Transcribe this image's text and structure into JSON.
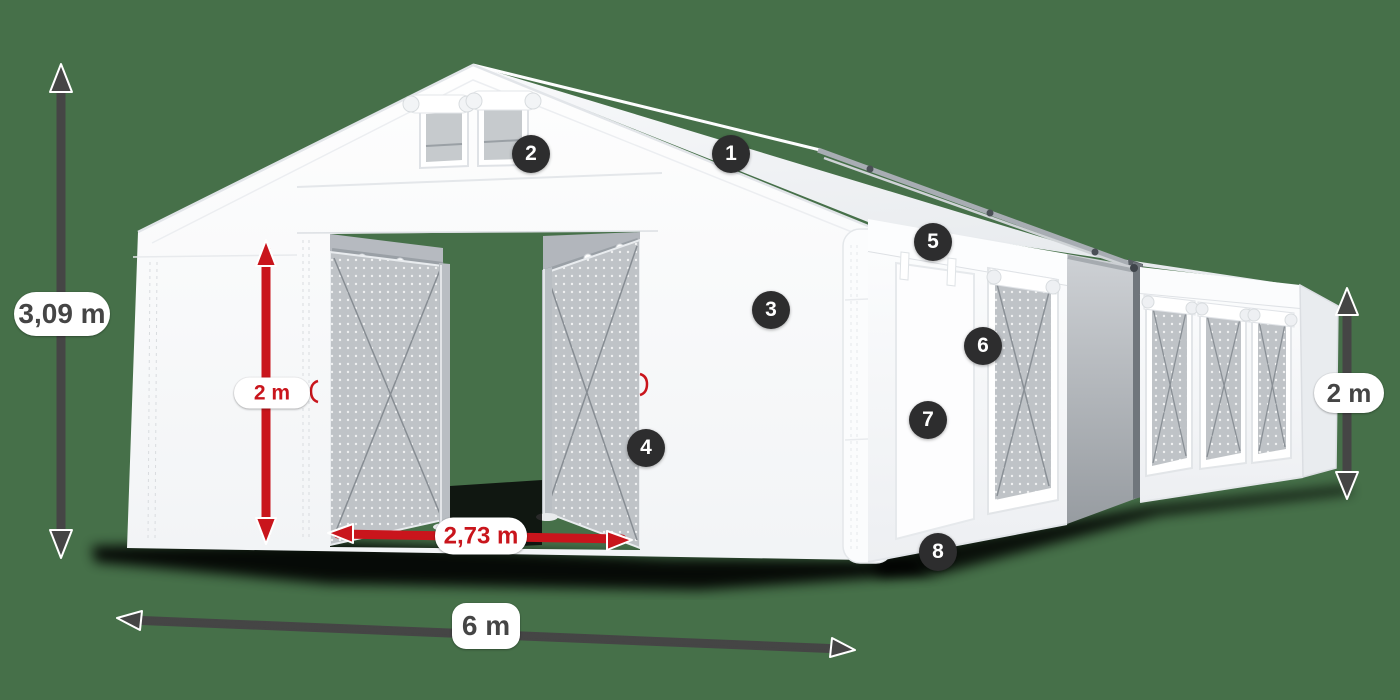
{
  "scene": {
    "description": "white-marquee-tent-product-diagram",
    "background_color": "#467049"
  },
  "colors": {
    "background_green": "#467049",
    "accent_red": "#c9151c",
    "annotation_dark": "#454545",
    "badge_bg": "#2d2d2e",
    "badge_text": "#ffffff",
    "label_bg": "#ffffff",
    "tent_white": "#fafbfc",
    "mesh_gray": "#bfc3c7",
    "shadow_black": "#060606"
  },
  "dimensions": {
    "total_height": {
      "label": "3,09 m",
      "style": "dark"
    },
    "entrance_height": {
      "label": "2 m",
      "style": "red"
    },
    "entrance_width": {
      "label": "2,73 m",
      "style": "red"
    },
    "width": {
      "label": "6 m",
      "style": "dark"
    },
    "side_height": {
      "label": "2 m",
      "style": "dark"
    }
  },
  "callouts": [
    {
      "number": "1"
    },
    {
      "number": "2"
    },
    {
      "number": "3"
    },
    {
      "number": "4"
    },
    {
      "number": "5"
    },
    {
      "number": "6"
    },
    {
      "number": "7"
    },
    {
      "number": "8"
    }
  ]
}
